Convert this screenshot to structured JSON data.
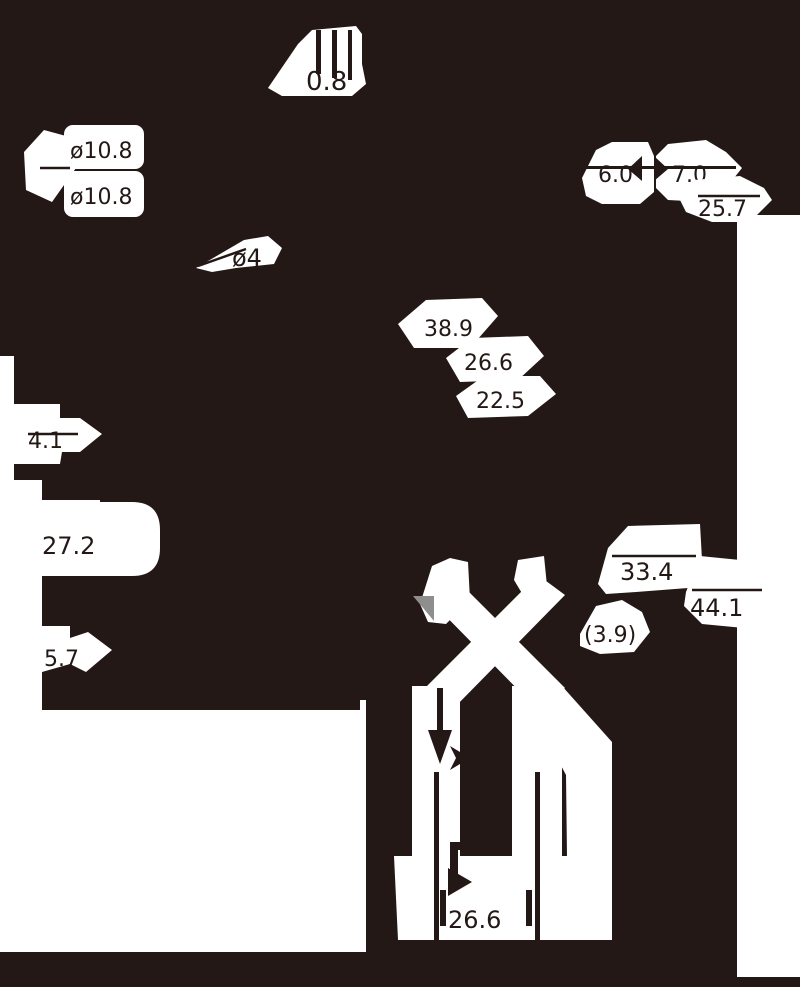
{
  "drawing": {
    "type": "technical-dimension-drawing",
    "colors": {
      "background": "#231815",
      "mask_white": "#ffffff",
      "dimension_text": "#231815",
      "leader_arrow_gray": "#8e8e8e"
    },
    "dims": {
      "top_thickness": "0.8",
      "hole_dia_top": "ø10.8",
      "hole_dia_bottom": "ø10.8",
      "small_hole_dia": "ø4",
      "right_width_a": "6.0",
      "right_width_b": "7.0",
      "right_offset": "25.7",
      "mid_span_a": "38.9",
      "mid_span_b": "26.6",
      "mid_span_c": "22.5",
      "left_step": "4.1",
      "left_height": "27.2",
      "left_gap": "5.7",
      "lower_span_a": "33.4",
      "lower_span_b": "44.1",
      "lower_ref": "(3.9)",
      "bottom_width": "26.6"
    }
  }
}
